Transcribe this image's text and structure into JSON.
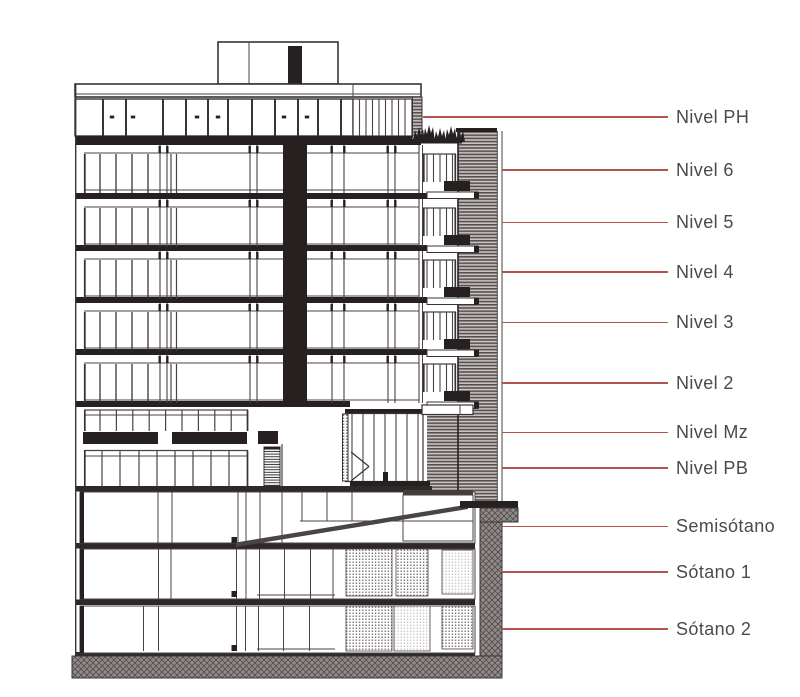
{
  "diagram": {
    "type": "architectural-building-section",
    "accent_color": "#b5544d",
    "label_color": "#4a4a4a",
    "levels": [
      {
        "id": "nivel-ph",
        "label": "Nivel PH"
      },
      {
        "id": "nivel-6",
        "label": "Nivel 6"
      },
      {
        "id": "nivel-5",
        "label": "Nivel 5"
      },
      {
        "id": "nivel-4",
        "label": "Nivel 4"
      },
      {
        "id": "nivel-3",
        "label": "Nivel 3"
      },
      {
        "id": "nivel-2",
        "label": "Nivel 2"
      },
      {
        "id": "nivel-mz",
        "label": "Nivel Mz"
      },
      {
        "id": "nivel-pb",
        "label": "Nivel PB"
      },
      {
        "id": "semisotano",
        "label": "Semisótano"
      },
      {
        "id": "sotano-1",
        "label": "Sótano 1"
      },
      {
        "id": "sotano-2",
        "label": "Sótano 2"
      }
    ]
  }
}
